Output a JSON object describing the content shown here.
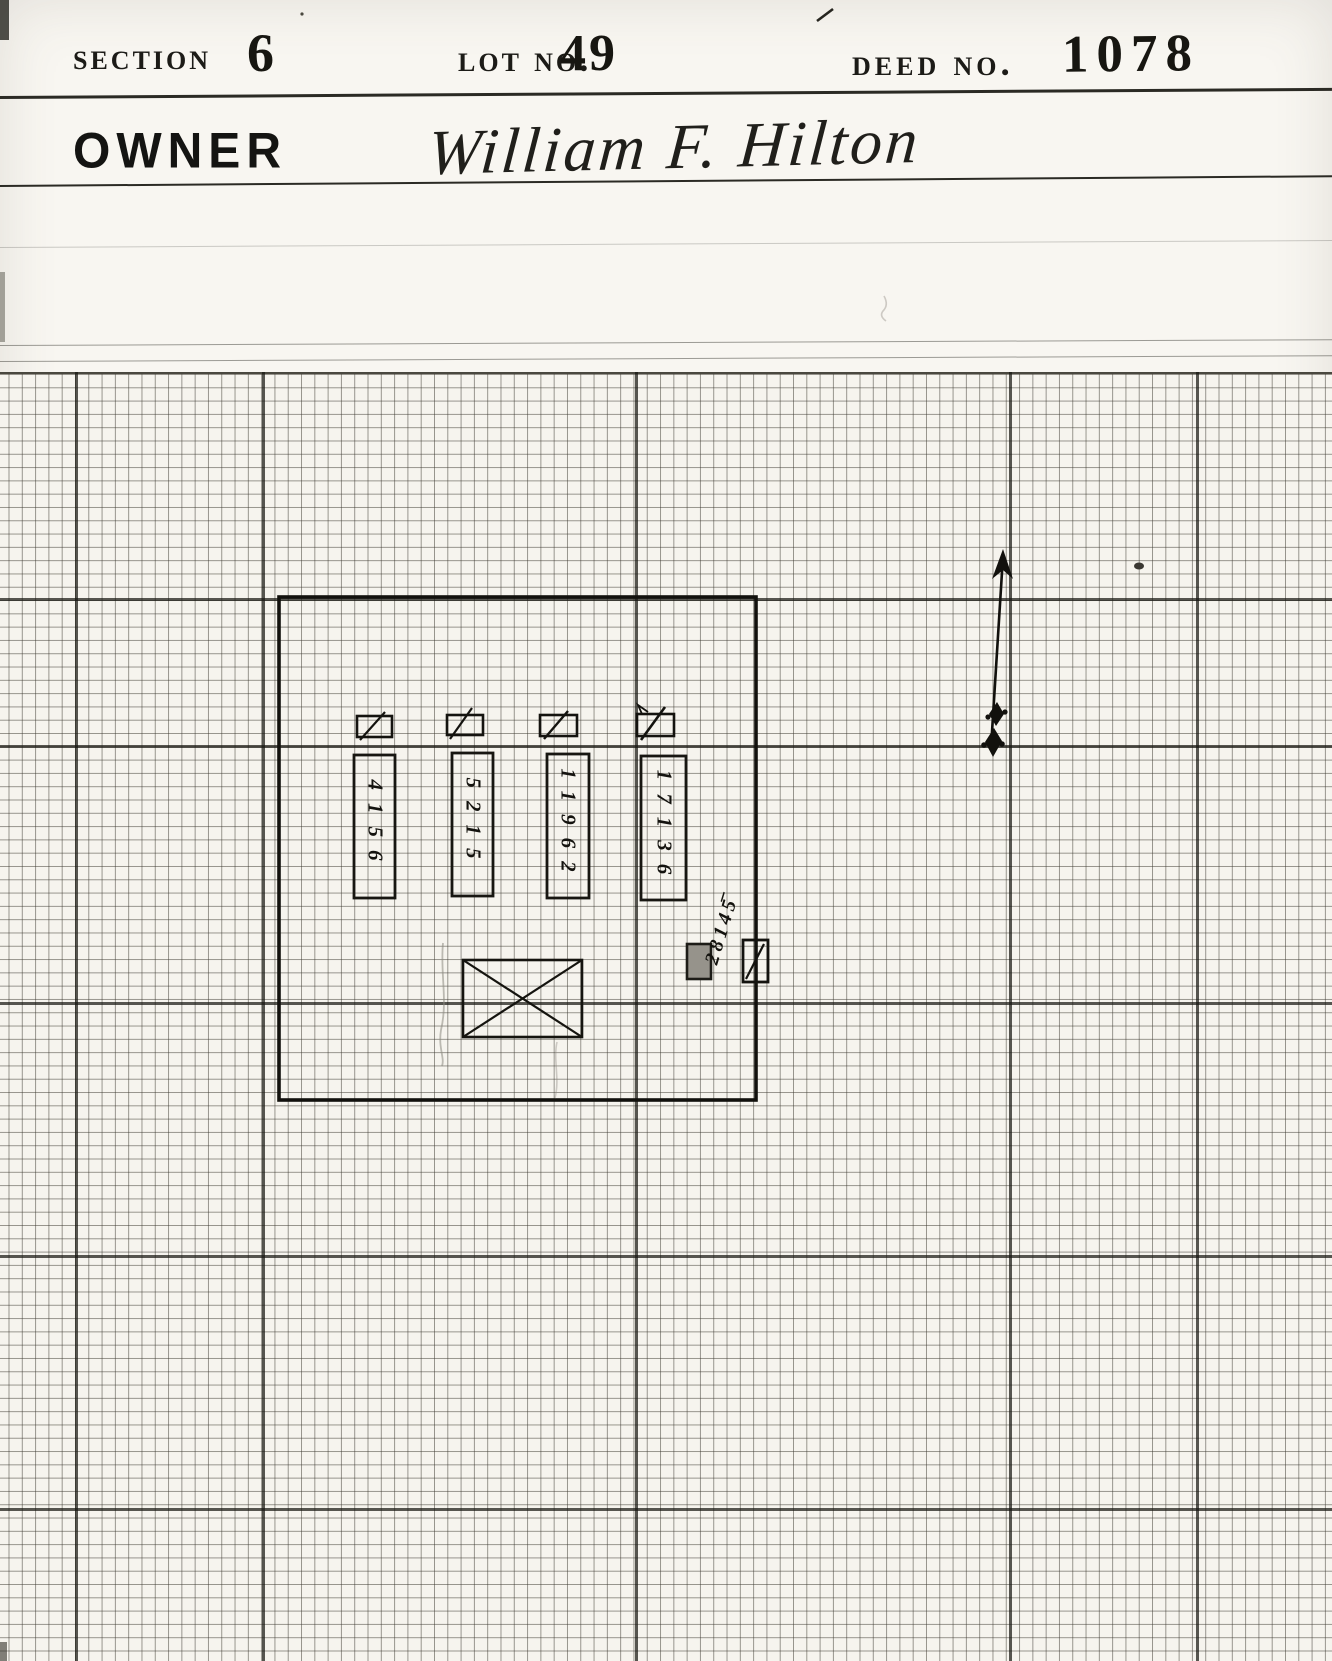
{
  "header": {
    "section": {
      "label": "Section",
      "value": "6"
    },
    "lot": {
      "label": "Lot No.",
      "value": "49"
    },
    "deed": {
      "label": "Deed No.",
      "value": "1078"
    },
    "owner": {
      "label": "OWNER",
      "value": "William F. Hilton"
    }
  },
  "plot": {
    "interment_numbers": [
      "4156",
      "5215",
      "11962",
      "17136",
      "28145̅"
    ]
  },
  "colors": {
    "paper": "#f8f6f1",
    "ink": "#14130f",
    "grid_line": "#57544b"
  }
}
